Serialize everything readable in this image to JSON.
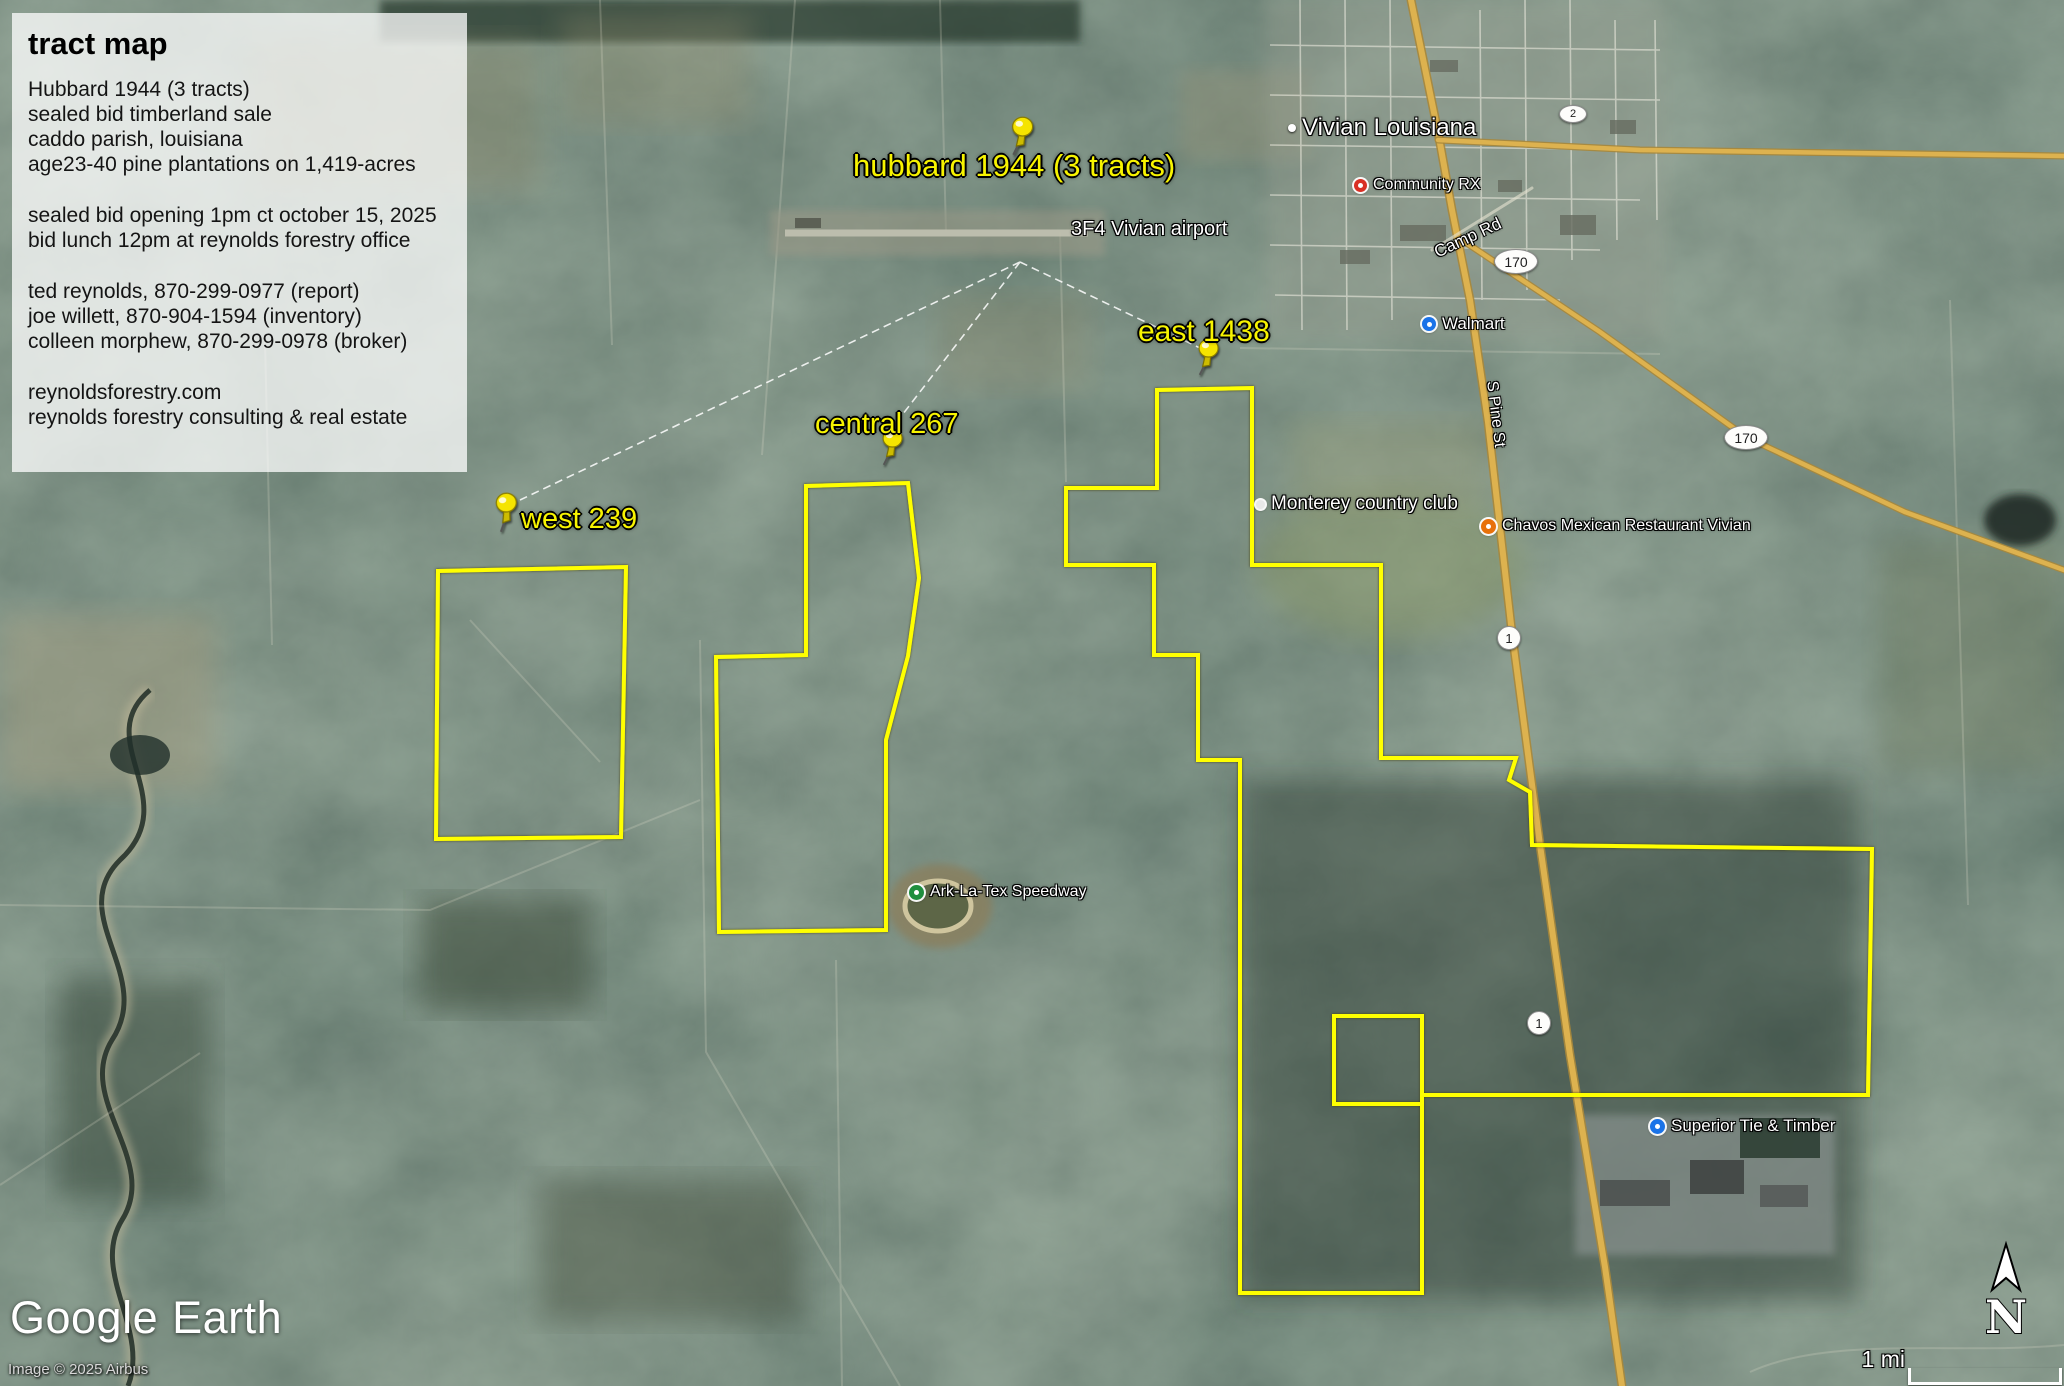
{
  "info_box": {
    "title": "tract map",
    "paragraphs": [
      [
        "Hubbard 1944 (3 tracts)",
        "sealed bid timberland sale",
        "caddo parish, louisiana",
        "age23-40 pine plantations on 1,419-acres"
      ],
      [
        "sealed bid opening 1pm ct october 15, 2025",
        "bid lunch 12pm at reynolds forestry office"
      ],
      [
        "ted reynolds, 870-299-0977 (report)",
        "joe willett, 870-904-1594 (inventory)",
        "colleen morphew, 870-299-0978 (broker)"
      ],
      [
        "reynoldsforestry.com",
        "reynolds forestry consulting & real estate"
      ]
    ]
  },
  "tracts": {
    "hubbard_label": "hubbard 1944 (3 tracts)",
    "east_label": "east 1438",
    "central_label": "central 267",
    "west_label": "west 239",
    "outline_color": "#ffff00",
    "label_color": "#f8f400"
  },
  "places": {
    "city": "Vivian Louisiana",
    "airport": "3F4 Vivian airport",
    "pharmacy": "Community RX",
    "walmart": "Walmart",
    "country_club": "Monterey country club",
    "restaurant": "Chavos Mexican Restaurant Vivian",
    "speedway": "Ark-La-Tex Speedway",
    "timber_mill": "Superior Tie & Timber"
  },
  "roads": {
    "camp_rd": "Camp Rd",
    "pine_st": "S Pine St",
    "hwy2": "2",
    "hwy170": "170",
    "hwy1": "1",
    "highway_color": "#ddb24f"
  },
  "icons": {
    "pushpin": "yellow-pushpin",
    "pharmacy_dot": "#d93025",
    "walmart_dot": "#1a73e8",
    "restaurant_dot": "#e8710a",
    "speedway_dot": "#1e8e3e",
    "timber_dot": "#1a73e8"
  },
  "attribution": {
    "logo_google": "Google",
    "logo_earth": "Earth",
    "copyright": "Image © 2025 Airbus"
  },
  "compass": {
    "north_label": "N"
  },
  "scale_bar": {
    "label": "1 mi"
  }
}
